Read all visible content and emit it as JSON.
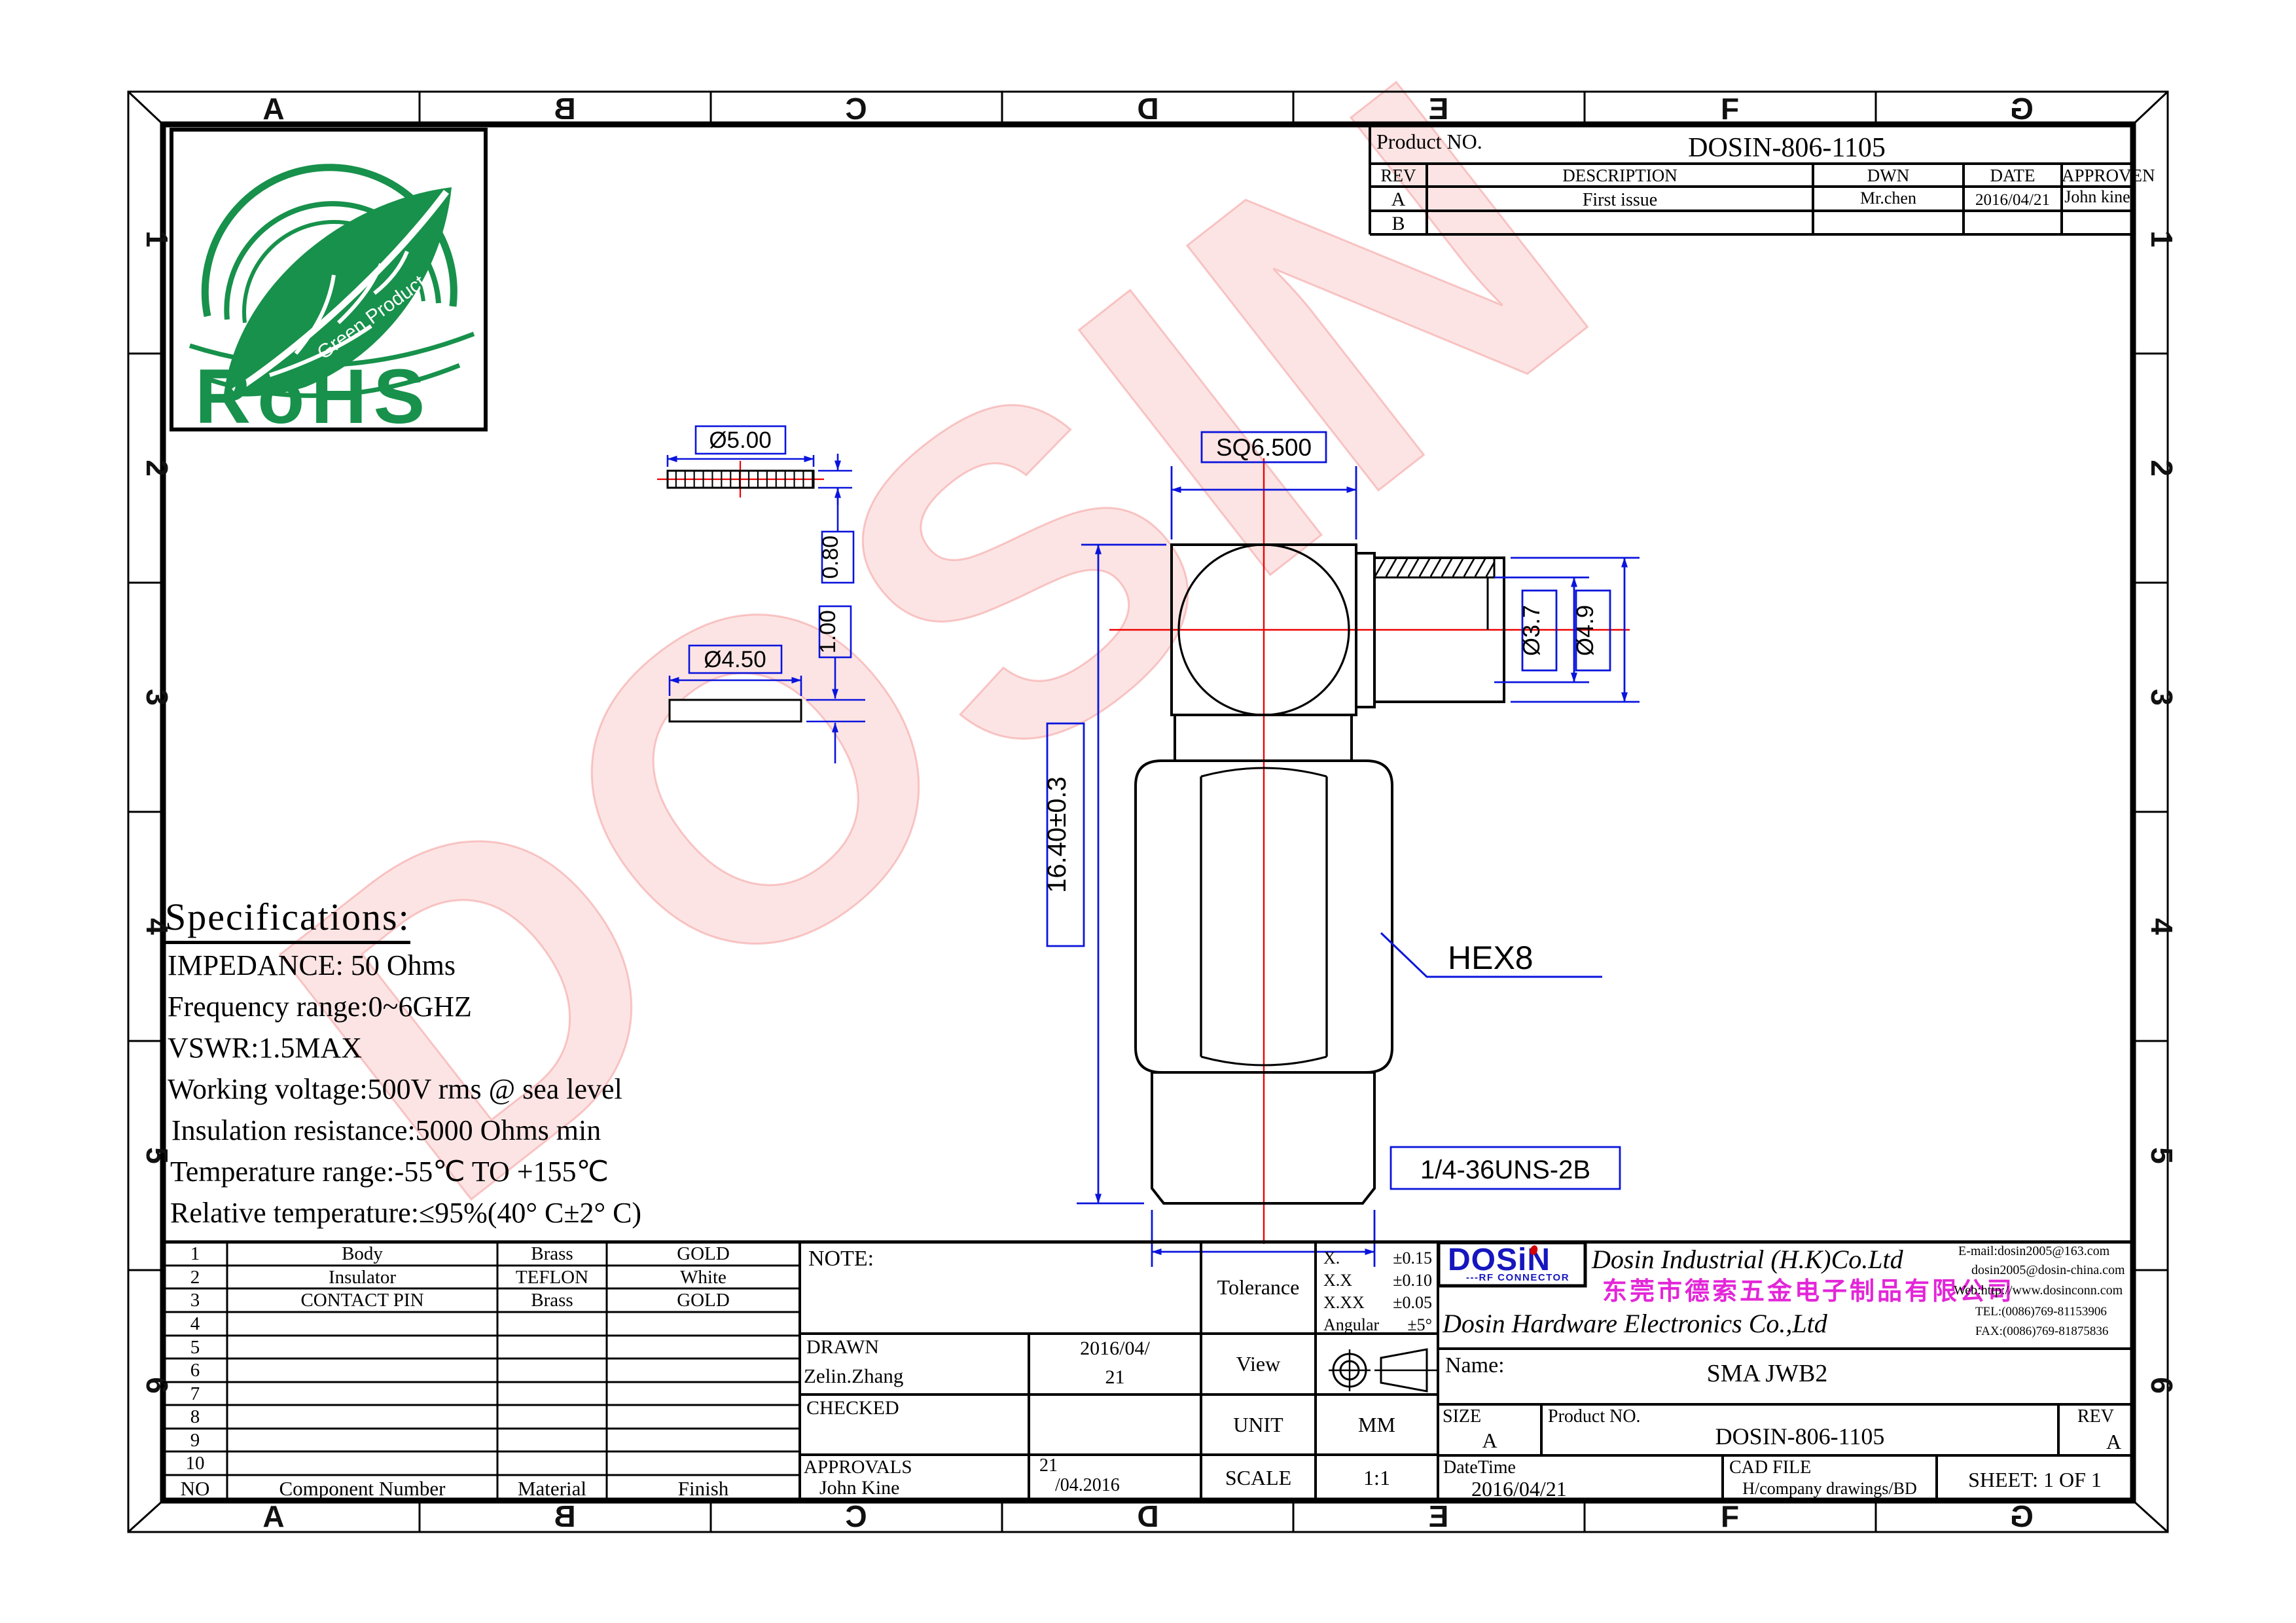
{
  "zones": {
    "letters": [
      "A",
      "B",
      "C",
      "D",
      "E",
      "F",
      "G"
    ],
    "numbers": [
      "1",
      "2",
      "3",
      "4",
      "5",
      "6"
    ]
  },
  "rohs": {
    "title": "RoHS",
    "subtitle": "Green Product"
  },
  "watermark": "DOSIN",
  "title_block": {
    "product_label": "Product NO.",
    "product_no": "DOSIN-806-1105",
    "headers": [
      "REV",
      "DESCRIPTION",
      "DWN",
      "DATE",
      "APPROVEN"
    ],
    "rows": [
      {
        "rev": "A",
        "description": "First issue",
        "dwn": "Mr.chen",
        "date": "2016/04/21",
        "approven": "John kine"
      },
      {
        "rev": "B",
        "description": "",
        "dwn": "",
        "date": "",
        "approven": ""
      }
    ]
  },
  "specs": {
    "title": "Specifications:",
    "lines": [
      "IMPEDANCE: 50 Ohms",
      "Frequency range:0~6GHZ",
      "VSWR:1.5MAX",
      "Working voltage:500V rms @ sea level",
      "Insulation resistance:5000 Ohms min",
      "Temperature range:-55℃ TO +155℃",
      "Relative temperature:≤95%(40° C±2° C)"
    ]
  },
  "dimensions": {
    "d1": "Ø5.00",
    "d2": "0.80",
    "d3": "1.00",
    "d4": "Ø4.50",
    "d5": "SQ6.500",
    "d6": "Ø3.7",
    "d7": "Ø4.9",
    "d8": "16.40±0.3",
    "d9": "HEX8",
    "d10": "1/4-36UNS-2B"
  },
  "parts_table": {
    "headers": {
      "no": "NO",
      "component": "Component Number",
      "material": "Material",
      "finish": "Finish"
    },
    "rows": [
      {
        "no": "1",
        "component": "Body",
        "material": "Brass",
        "finish": "GOLD"
      },
      {
        "no": "2",
        "component": "Insulator",
        "material": "TEFLON",
        "finish": "White"
      },
      {
        "no": "3",
        "component": "CONTACT PIN",
        "material": "Brass",
        "finish": "GOLD"
      },
      {
        "no": "4",
        "component": "",
        "material": "",
        "finish": ""
      },
      {
        "no": "5",
        "component": "",
        "material": "",
        "finish": ""
      },
      {
        "no": "6",
        "component": "",
        "material": "",
        "finish": ""
      },
      {
        "no": "7",
        "component": "",
        "material": "",
        "finish": ""
      },
      {
        "no": "8",
        "component": "",
        "material": "",
        "finish": ""
      },
      {
        "no": "9",
        "component": "",
        "material": "",
        "finish": ""
      },
      {
        "no": "10",
        "component": "",
        "material": "",
        "finish": ""
      }
    ]
  },
  "note_block": {
    "note_label": "NOTE:",
    "drawn_label": "DRAWN",
    "drawn_name": "Zelin.Zhang",
    "drawn_date_line1": "2016/04/",
    "drawn_date_line2": "21",
    "checked_label": "CHECKED",
    "approvals_label": "APPROVALS",
    "approvals_name": "John Kine",
    "approvals_date_line1": "21",
    "approvals_date_line2": "/04.2016"
  },
  "tolerance_block": {
    "label": "Tolerance",
    "rows": [
      {
        "name": "X.",
        "value": "±0.15"
      },
      {
        "name": "X.X",
        "value": "±0.10"
      },
      {
        "name": "X.XX",
        "value": "±0.05"
      },
      {
        "name": "Angular",
        "value": "±5°"
      }
    ]
  },
  "view_block": {
    "label": "View"
  },
  "unit_block": {
    "label": "UNIT",
    "value": "MM"
  },
  "scale_block": {
    "label": "SCALE",
    "value": "1:1"
  },
  "company": {
    "logo_text": "DOSiN",
    "logo_sub": "---RF CONNECTOR",
    "name_en1": "Dosin Industrial (H.K)Co.Ltd",
    "name_cn": "东莞市德索五金电子制品有限公司",
    "name_en2": "Dosin Hardware Electronics Co.,Ltd",
    "email1": "E-mail:dosin2005@163.com",
    "email2": "dosin2005@dosin-china.com",
    "web": "Web:http://www.dosinconn.com",
    "tel": "TEL:(0086)769-81153906",
    "fax": "FAX:(0086)769-81875836"
  },
  "name_block": {
    "label": "Name:",
    "value": "SMA JWB2"
  },
  "size_block": {
    "size_label": "SIZE",
    "size_value": "A",
    "product_label": "Product NO.",
    "product_value": "DOSIN-806-1105",
    "rev_label": "REV",
    "rev_value": "A"
  },
  "footer_block": {
    "datetime_label": "DateTime",
    "datetime_value": "2016/04/21",
    "cad_label": "CAD FILE",
    "cad_value": "H/company drawings/BD",
    "sheet_label": "SHEET: 1 OF 1"
  },
  "colors": {
    "dim_blue": "#0a14dc",
    "center_red": "#ee0000",
    "rohs_green": "#17914b",
    "logo_blue": "#1616bf",
    "cn_magenta": "#e326d8",
    "watermark_pink": "#ed5a5a"
  }
}
